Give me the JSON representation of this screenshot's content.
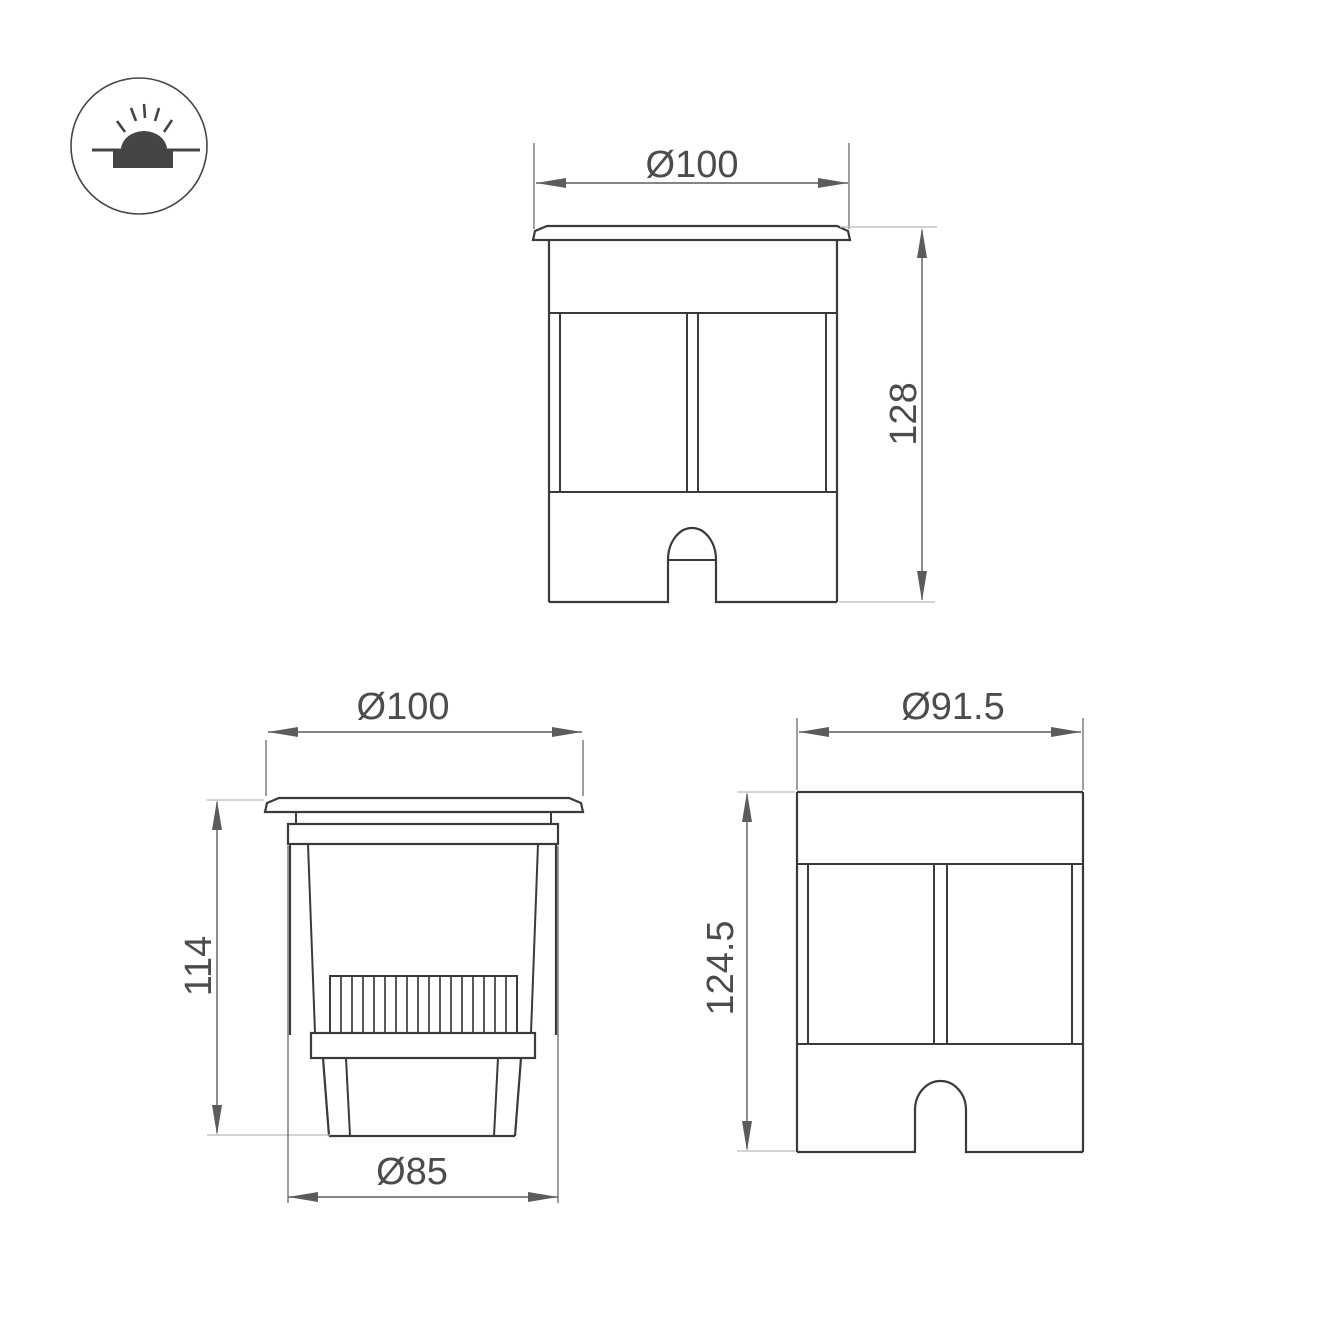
{
  "colors": {
    "line": "#3a3a3a",
    "dim": "#5c5c5c",
    "leader": "#b9b9b9",
    "text": "#4c4c4c",
    "icon": "#454545",
    "background": "#ffffff"
  },
  "icon": {
    "name": "recessed-ground-light-icon"
  },
  "dimensions": {
    "front_view": {
      "diameter": "Ø100",
      "height": "128"
    },
    "section_view": {
      "diameter": "Ø100",
      "height": "114",
      "base_diameter": "Ø85"
    },
    "housing_view": {
      "diameter": "Ø91.5",
      "height": "124.5"
    }
  }
}
